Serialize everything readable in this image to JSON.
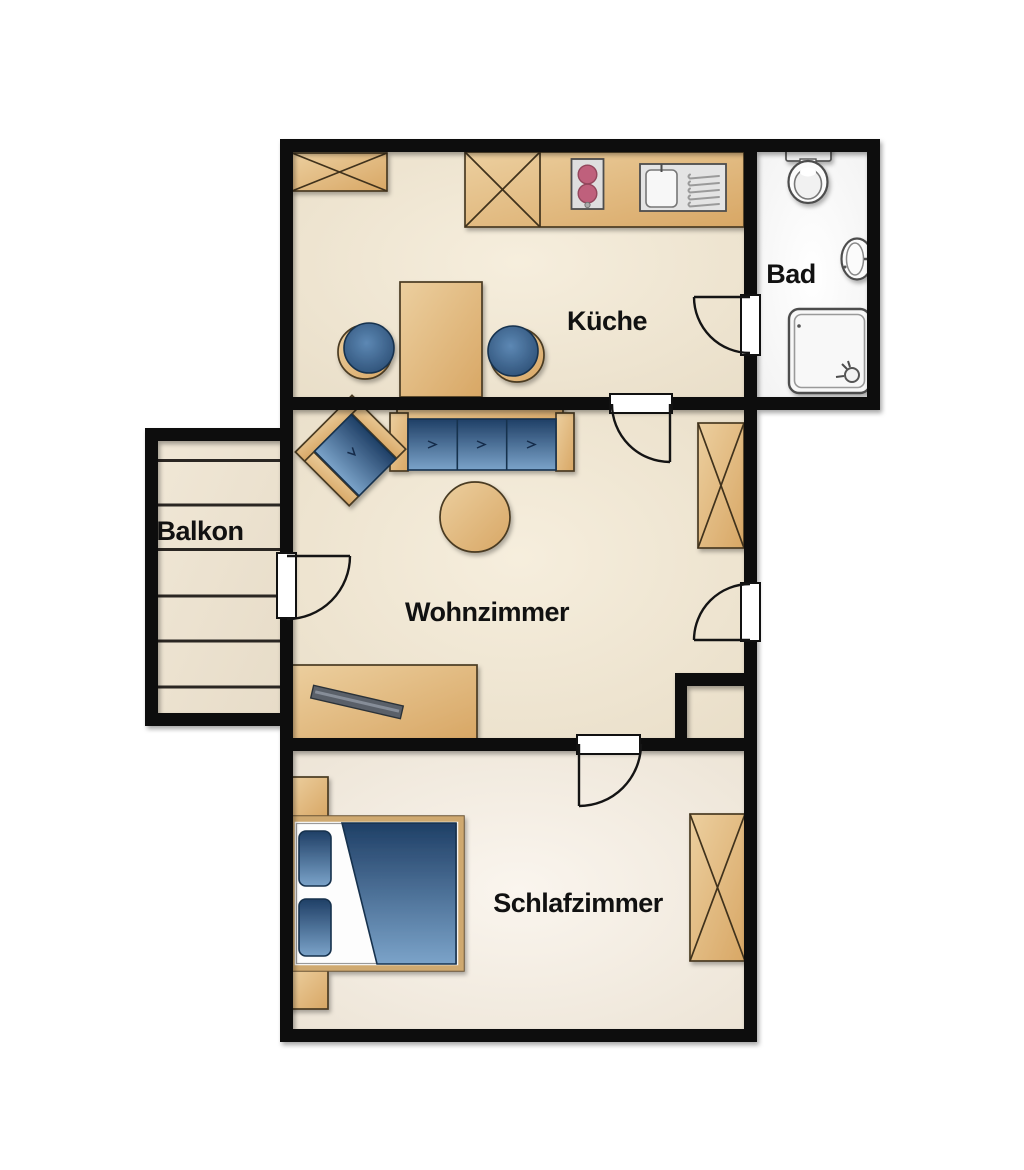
{
  "rooms": {
    "kueche": {
      "label": "Küche",
      "furniture": [
        "wall-cabinet",
        "kitchen-counter",
        "stove",
        "sink",
        "dining-table",
        "chair",
        "chair"
      ]
    },
    "bad": {
      "label": "Bad",
      "furniture": [
        "toilet",
        "washbasin",
        "shower"
      ]
    },
    "balkon": {
      "label": "Balkon",
      "furniture": [
        "decking-planks"
      ]
    },
    "wohnzimmer": {
      "label": "Wohnzimmer",
      "furniture": [
        "sofa",
        "armchair",
        "coffee-table",
        "wardrobe",
        "sideboard",
        "tv"
      ]
    },
    "schlafzimmer": {
      "label": "Schlafzimmer",
      "furniture": [
        "double-bed",
        "nightstand",
        "nightstand",
        "wardrobe"
      ]
    }
  },
  "colors": {
    "wall": "#111111",
    "background": "#ffffff",
    "floor_main": "#f1e8d8",
    "floor_bedroom": "#f7f3ec",
    "floor_bath": "#fdfdfd",
    "furniture_tan": "#e0b97f",
    "furniture_outline": "#4a3a22",
    "upholstery_blue": "#35608f",
    "burner_rose": "#bf607b",
    "fixture_gray": "#f6f6f6",
    "tv_gray": "#5a6069",
    "label_text": "#111111"
  }
}
